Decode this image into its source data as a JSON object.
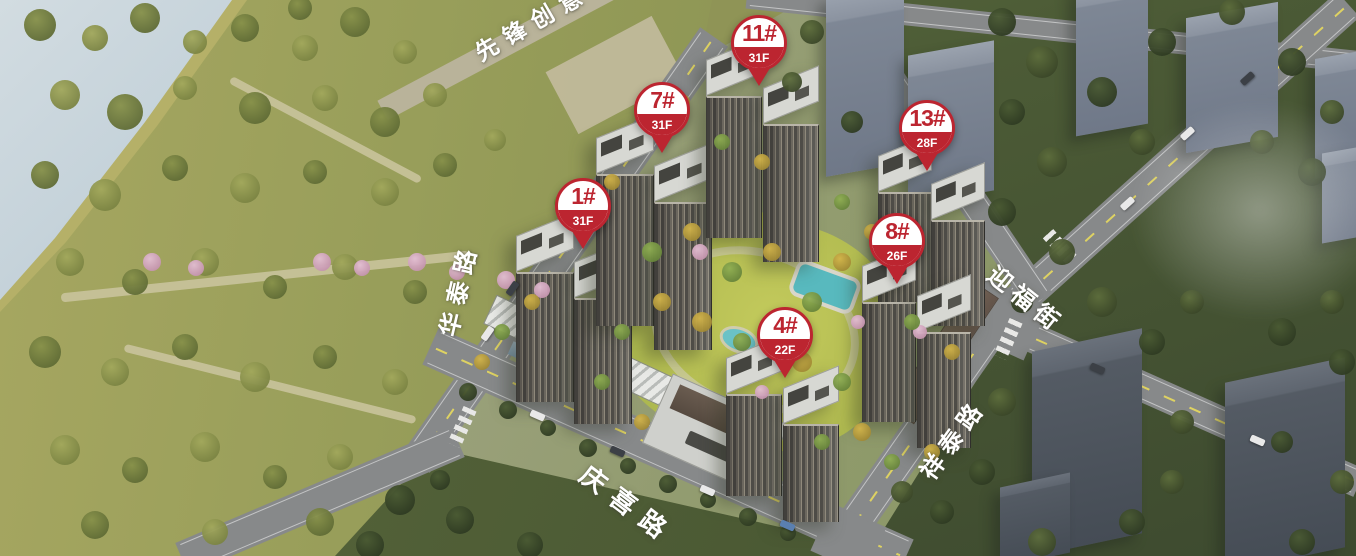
{
  "scene": {
    "description": "Aerial rendering of a residential masterplan with numbered building markers and street name overlays",
    "colors": {
      "pin_red": "#bc2530",
      "label_white": "#ffffff",
      "water": "#a9bfcc",
      "park_green": "#939a58",
      "forest_green": "#4c5b36",
      "lawn_green": "#b9c055",
      "pool_teal": "#58b9be",
      "road_grey": "#87898a"
    }
  },
  "pins": [
    {
      "label": "1#",
      "floors": "31F"
    },
    {
      "label": "4#",
      "floors": "22F"
    },
    {
      "label": "7#",
      "floors": "31F"
    },
    {
      "label": "8#",
      "floors": "26F"
    },
    {
      "label": "11#",
      "floors": "31F"
    },
    {
      "label": "13#",
      "floors": "28F"
    }
  ],
  "roads": [
    {
      "name": "先锋创意"
    },
    {
      "name": "华泰路"
    },
    {
      "name": "迎福街"
    },
    {
      "name": "祥泰路"
    },
    {
      "name": "庆喜路"
    }
  ]
}
